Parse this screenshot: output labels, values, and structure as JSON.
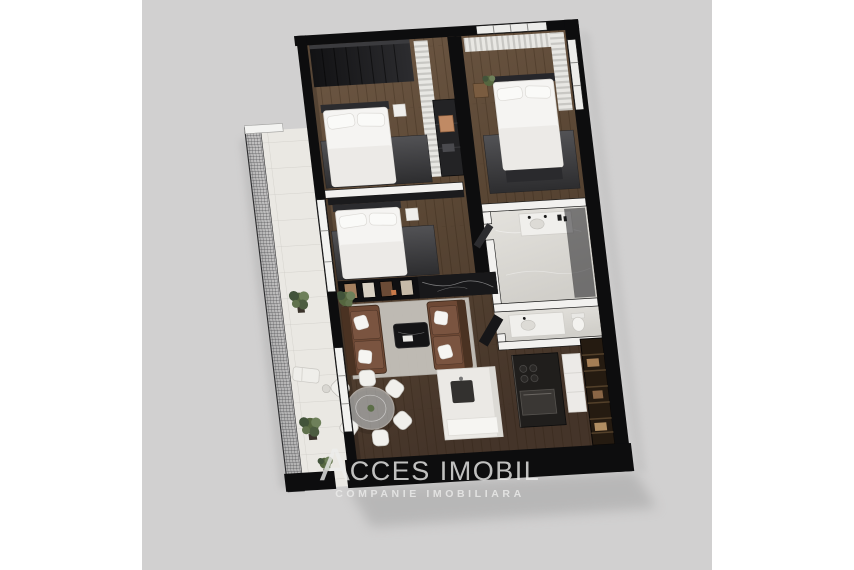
{
  "scene": {
    "description": "3D isometric floor-plan render of an apartment, tilted clockwise, on a light gray square backdrop centered in a white page",
    "rooms": [
      {
        "id": "bedroom-1",
        "position": "top-left",
        "furniture": [
          "wardrobe",
          "double-bed",
          "dark-rug",
          "dresser",
          "curtain"
        ]
      },
      {
        "id": "bedroom-2",
        "position": "middle-left",
        "furniture": [
          "double-bed",
          "dark-rug",
          "decor-console"
        ]
      },
      {
        "id": "bedroom-3",
        "position": "top-right",
        "furniture": [
          "double-bed",
          "dark-rug",
          "curtains",
          "plant",
          "nightstand"
        ]
      },
      {
        "id": "bathroom-1",
        "position": "right",
        "furniture": [
          "vanity",
          "shower-glass",
          "open-door"
        ]
      },
      {
        "id": "bathroom-2",
        "position": "right-lower",
        "furniture": [
          "vanity",
          "toilet",
          "open-door"
        ]
      },
      {
        "id": "living-room",
        "position": "center",
        "furniture": [
          "two-leather-sofas",
          "white-pillows",
          "coffee-table",
          "light-rug",
          "plant"
        ]
      },
      {
        "id": "dining-area",
        "position": "bottom-left",
        "furniture": [
          "round-glass-table",
          "six-white-chairs"
        ]
      },
      {
        "id": "kitchen",
        "position": "bottom-center",
        "furniture": [
          "white-island",
          "sink",
          "dark-counter",
          "cooktop",
          "oven"
        ]
      },
      {
        "id": "hallway",
        "position": "bottom-right",
        "furniture": [
          "shelved-wardrobe",
          "white-cabinet"
        ]
      },
      {
        "id": "balcony",
        "position": "left",
        "furniture": [
          "mesh-railing",
          "plants",
          "lounge-chair"
        ]
      }
    ]
  },
  "watermark": {
    "initial": "A",
    "name_rest": "CCES IMOBIL",
    "name_full": "ACCES IMOBIL",
    "tagline": "COMPANIE IMOBILIARA"
  },
  "palette": {
    "page_bg": "#ffffff",
    "photo_bg": "#d1d0d0",
    "wall_black": "#0d0d0e",
    "wood_floor": "#5f4b39",
    "marble_floor": "#dcdad5",
    "balcony_floor": "#eae8e3",
    "rug_dark": "#3e3e41",
    "rug_light": "#c8c5bf",
    "sofa_brown": "#6d4834",
    "bed_white": "#f5f4f2",
    "plant_green": "#5c6e48",
    "kitchen_dark": "#201e1c",
    "wardrobe_brown": "#251b11",
    "shadow_gray": "#9f9f9f",
    "logo_white": "#ededec"
  }
}
